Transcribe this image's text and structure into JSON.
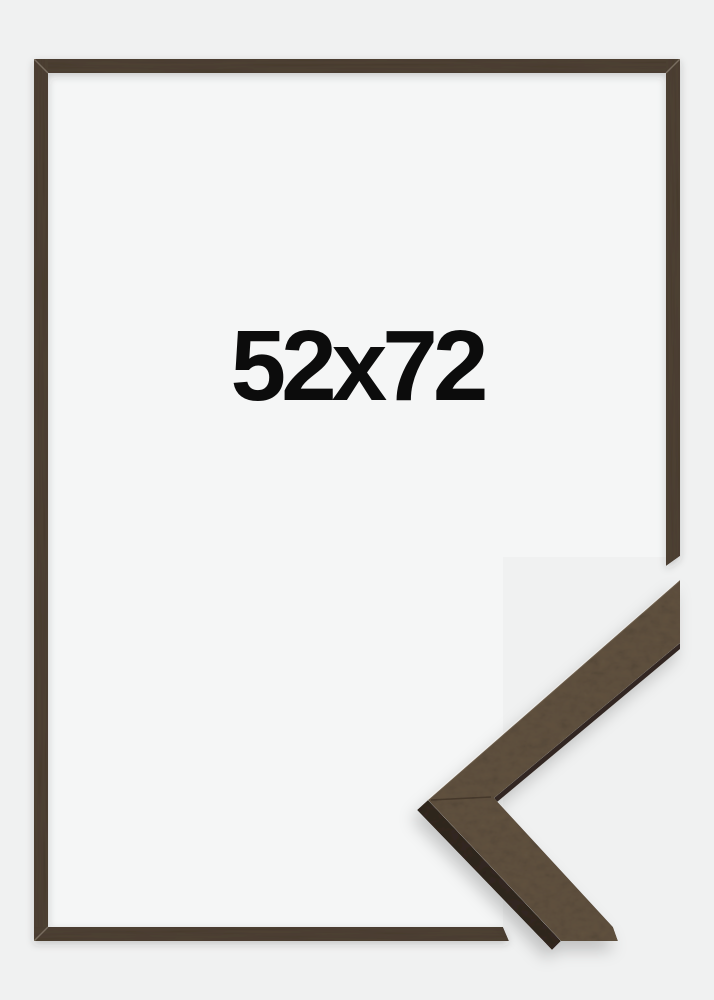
{
  "label": {
    "text": "52x72"
  },
  "colors": {
    "background": "#f0f1f1",
    "interior": "#f5f6f6",
    "frame_wood": "#4e4133",
    "sample_face": "#60513f",
    "sample_side": "#322820",
    "label_text": "#0c0c0c"
  }
}
